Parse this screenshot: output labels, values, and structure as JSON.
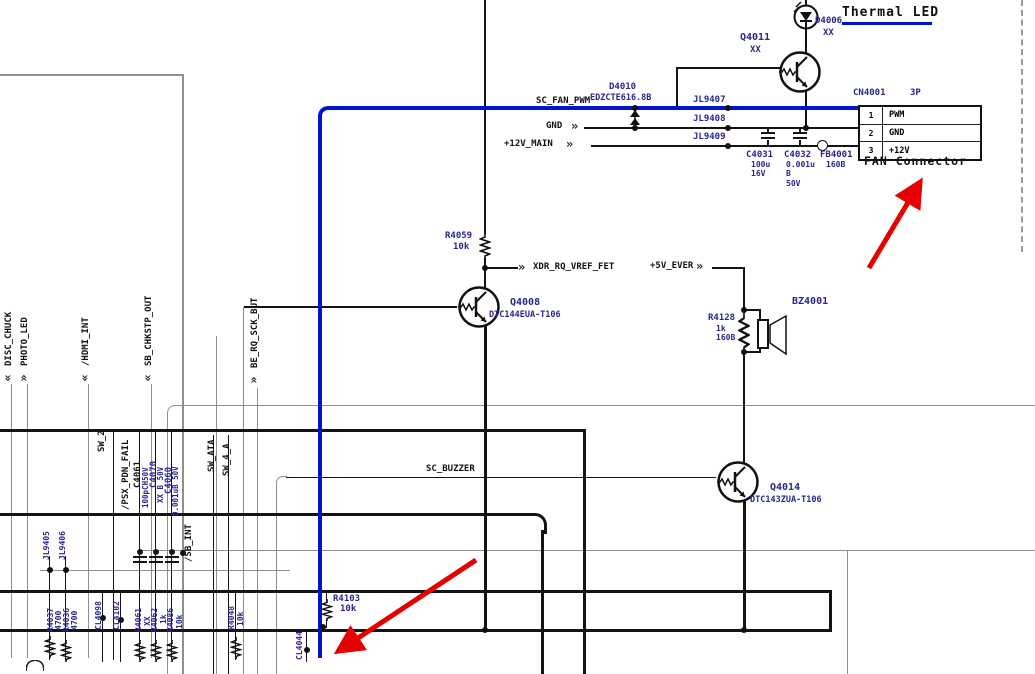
{
  "title": {
    "text": "Thermal LED"
  },
  "connector": {
    "ref": "CN4001",
    "size": "3P",
    "caption": "FAN Connector",
    "pins": [
      {
        "num": "1",
        "name": "PWM"
      },
      {
        "num": "2",
        "name": "GND"
      },
      {
        "num": "3",
        "name": "+12V"
      }
    ]
  },
  "nets": {
    "sc_fan_pwm": "SC_FAN_PWM",
    "gnd": "GND",
    "v12_main": "+12V_MAIN",
    "xdr": "XDR_RQ_VREF_FET",
    "v5_ever": "+5V_EVER",
    "sc_buzzer": "SC_BUZZER"
  },
  "icons": {
    "chevron_right": "»"
  },
  "colors": {
    "trace_highlight": "#0013cf",
    "annotation_arrow": "#e60000",
    "refdes": "#27278f"
  },
  "left_pins": [
    {
      "name": "DISC_CHUCK",
      "arrow": "«"
    },
    {
      "name": "PHOTO_LED",
      "arrow": "»"
    },
    {
      "name": "/HDMI_INT",
      "arrow": "«"
    },
    {
      "name": "SB_CHKSTP_OUT",
      "arrow": "«"
    },
    {
      "name": "BE_RQ_SCK_BUT",
      "arrow": "»"
    }
  ],
  "mid_labels": {
    "sw_2": "SW_2",
    "psx_pdn_fail": "/PSX_PDN_FAIL",
    "sw_ata": "SW_ATA",
    "sw_4_a": "SW_4_A",
    "sb_int": "/SB_INT"
  },
  "components": {
    "d4006": {
      "ref": "D4006",
      "val": "XX"
    },
    "q4011": {
      "ref": "Q4011",
      "val": "XX"
    },
    "d4010": {
      "ref": "D4010",
      "val": "EDZCTE616.8B"
    },
    "jl9407": {
      "ref": "JL9407"
    },
    "jl9408": {
      "ref": "JL9408"
    },
    "jl9409": {
      "ref": "JL9409"
    },
    "c4031": {
      "ref": "C4031",
      "val": "100u\n16V"
    },
    "c4032": {
      "ref": "C4032",
      "val": "0.001u\nB\n50V"
    },
    "fb4001": {
      "ref": "FB4001",
      "val": "160B"
    },
    "r4059": {
      "ref": "R4059",
      "val": "10k"
    },
    "q4008": {
      "ref": "Q4008",
      "val": "DTC144EUA-T106"
    },
    "r4128": {
      "ref": "R4128",
      "val": "1k\n160B"
    },
    "bz4001": {
      "ref": "BZ4001"
    },
    "q4014": {
      "ref": "Q4014",
      "val": "DTC143ZUA-T106"
    },
    "c4061": {
      "ref": "C4061",
      "val": "100pCH50V"
    },
    "c4070": {
      "ref": "C4070",
      "val": "XX B 50V"
    },
    "c4060": {
      "ref": "C4060",
      "val": "0.001uB 50V"
    },
    "jl9405": {
      "ref": "JL9405"
    },
    "jl9406": {
      "ref": "JL9406"
    },
    "r4037": {
      "ref": "R4037",
      "val": "4700"
    },
    "r4036": {
      "ref": "R4036",
      "val": "4700"
    },
    "cl4098": {
      "ref": "CL4098"
    },
    "cl4102": {
      "ref": "CL4102"
    },
    "r4061": {
      "ref": "R4061",
      "val": "XX"
    },
    "r4062": {
      "ref": "R4062",
      "val": "1k"
    },
    "r4086": {
      "ref": "R4086",
      "val": "10k"
    },
    "r4048": {
      "ref": "R4048",
      "val": "10k"
    },
    "r4103": {
      "ref": "R4103",
      "val": "10k"
    },
    "cl4044": {
      "ref": "CL4044"
    }
  }
}
